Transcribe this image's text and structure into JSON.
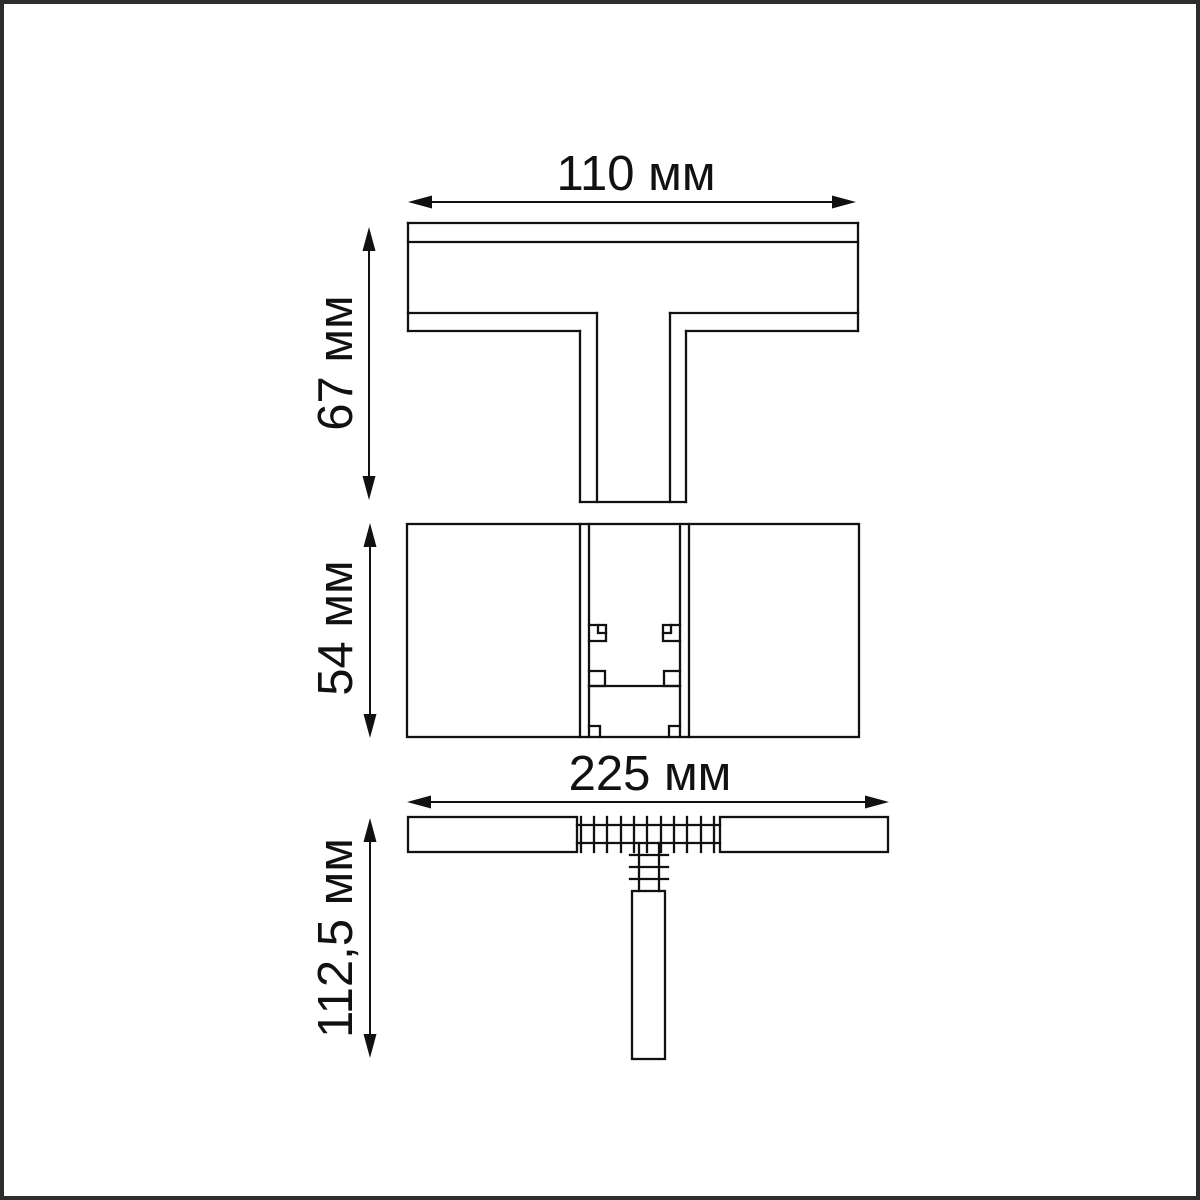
{
  "page": {
    "background": "#ffffff",
    "frame_color": "#2d2d2d",
    "line_color": "#111111"
  },
  "diagram": {
    "unit": "мм",
    "dimensions": {
      "top_width": {
        "label": "110 мм",
        "value": 110,
        "unit": "мм"
      },
      "top_height": {
        "label": "67 мм",
        "value": 67,
        "unit": "мм"
      },
      "middle_height": {
        "label": "54 мм",
        "value": 54,
        "unit": "мм"
      },
      "bottom_width": {
        "label": "225 мм",
        "value": 225,
        "unit": "мм"
      },
      "bottom_height": {
        "label": "112,5 мм",
        "value": 112.5,
        "unit": "мм"
      }
    }
  }
}
